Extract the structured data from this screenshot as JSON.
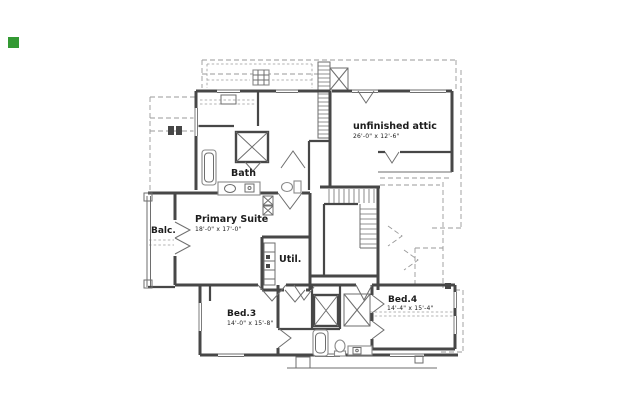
{
  "colors": {
    "wall": "#474747",
    "line": "#6e6e6e",
    "fixture": "#8a8a8a",
    "dashed": "#9a9a9a",
    "text": "#1c1c1c",
    "marker": "#339933"
  },
  "rooms": {
    "attic": {
      "label": "unfinished attic",
      "dims": "26'-0\" x 12'-6\""
    },
    "primary_suite": {
      "label": "Primary Suite",
      "dims": "18'-0\" x 17'-0\""
    },
    "bath": {
      "label": "Bath"
    },
    "balcony": {
      "label": "Balc."
    },
    "utility": {
      "label": "Util."
    },
    "bed3": {
      "label": "Bed.3",
      "dims": "14'-0\" x 15'-8\""
    },
    "bed4": {
      "label": "Bed.4",
      "dims": "14'-4\" x 15'-4\""
    }
  }
}
